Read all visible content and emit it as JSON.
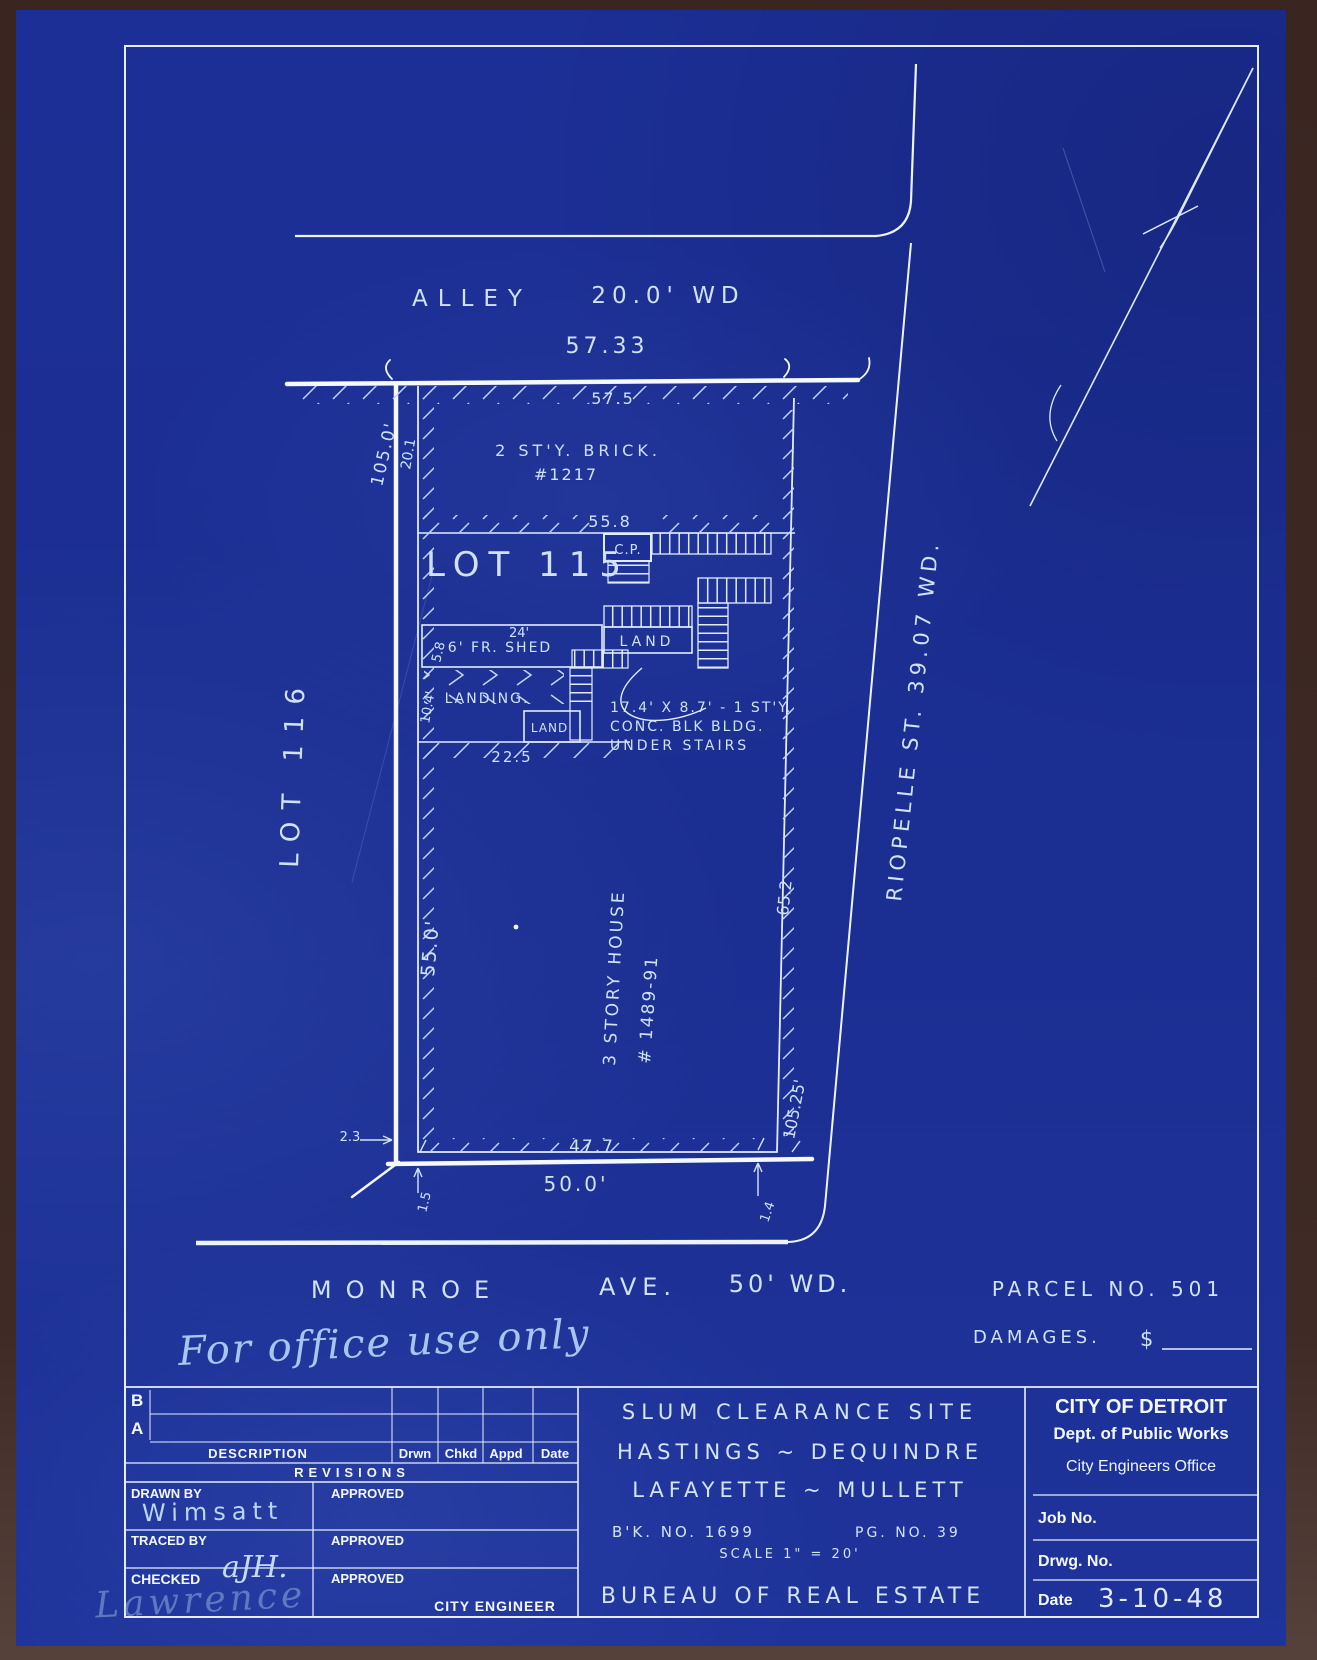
{
  "drawing": {
    "alley": {
      "name": "ALLEY",
      "width": "20.0' WD"
    },
    "monroe": {
      "name": "MONROE",
      "ave": "AVE.",
      "width": "50' WD."
    },
    "riopelle": {
      "label": "RIOPELLE  ST.  39.07 WD."
    },
    "lot115": "LOT 115",
    "lot116": "LOT 116",
    "brick": {
      "line1": "2 ST'Y. BRICK.",
      "line2": "#1217"
    },
    "house": {
      "line1": "3 STORY HOUSE",
      "line2": "# 1489-91"
    },
    "shed": "6' FR. SHED",
    "landing": "LANDING.",
    "land_big": "LAND",
    "land_small": "LAND.",
    "cp": "C.P.",
    "stair_note": {
      "line1": "17.4' X 8.7' - 1 ST'Y.",
      "line2": "CONC. BLK BLDG.",
      "line3": "UNDER STAIRS"
    },
    "dims": {
      "top_outer": "57.33",
      "top_inner": "57.5",
      "left_depth": "105.0'",
      "left_top": "20.1",
      "mid_width": "55.8",
      "shed_top": "24'",
      "shed_side": "5.8",
      "landing_side": "10.4'",
      "landing_bottom": "22.5",
      "west": "55.0'",
      "east": "65.2",
      "east_total": "105.25'",
      "sw_offset": "2.3",
      "bottom_inner": "47.7",
      "bottom_outer": "50.0'",
      "sw_small": "1.5",
      "se_small": "1.4"
    },
    "parcel": {
      "label": "PARCEL NO. 501",
      "damages": "DAMAGES.",
      "currency": "$"
    },
    "office_note": "For office use only"
  },
  "titleblock": {
    "revisions": {
      "row_b": "B",
      "row_a": "A",
      "description": "DESCRIPTION",
      "cols": [
        "Drwn",
        "Chkd",
        "Appd",
        "Date"
      ],
      "title": "REVISIONS"
    },
    "drawn_by": {
      "label": "DRAWN BY",
      "value": "Wimsatt"
    },
    "traced_by": {
      "label": "TRACED BY"
    },
    "checked": {
      "label": "CHECKED",
      "value": "aJH."
    },
    "approved": "APPROVED",
    "city_engineer": "CITY ENGINEER",
    "signature": "Lawrence",
    "project": {
      "line1": "SLUM CLEARANCE SITE",
      "line2": "HASTINGS ~ DEQUINDRE",
      "line3": "LAFAYETTE ~ MULLETT",
      "book": "B'K. NO. 1699",
      "page": "PG. NO. 39",
      "scale": "SCALE 1\" = 20'",
      "bureau": "BUREAU OF REAL ESTATE"
    },
    "agency": {
      "name": "CITY OF DETROIT",
      "dept": "Dept. of Public Works",
      "office": "City Engineers Office",
      "job": "Job No.",
      "drwg": "Drwg. No.",
      "date_label": "Date",
      "date_value": "3-10-48"
    }
  },
  "colors": {
    "paper": "#1c2f96",
    "ink": "#e9f2ff",
    "backing": "#3f2a25"
  }
}
